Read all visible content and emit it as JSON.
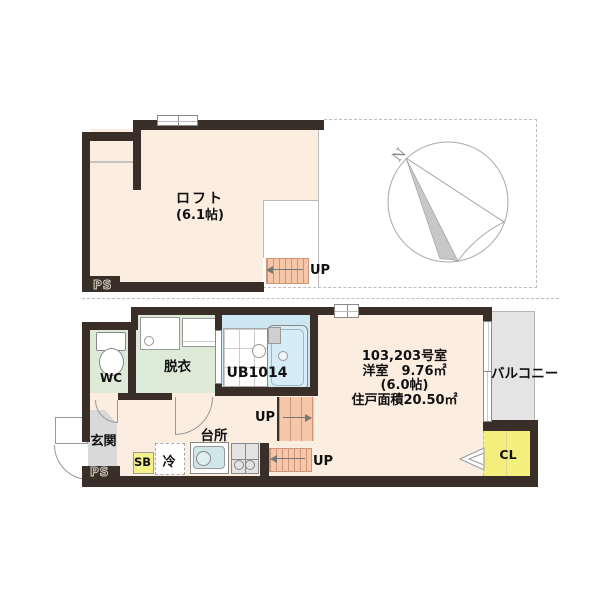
{
  "loft": {
    "name": "ロフト",
    "size": "(6.1帖)",
    "ps": "PS",
    "up": "UP"
  },
  "f1": {
    "wc": "WC",
    "dressing": "脱衣",
    "bath": "UB1014",
    "entrance": "玄関",
    "kitchen": "台所",
    "shoe_box": "SB",
    "fridge": "冷",
    "closet": "CL",
    "balcony": "バルコニー",
    "ps": "PS",
    "up_upper": "UP",
    "up_lower": "UP",
    "info_line1": "103,203号室",
    "info_line2": "洋室　9.76㎡",
    "info_line3": "(6.0帖)",
    "info_line4": "住戸面積20.50㎡"
  },
  "compass": {
    "north": "N"
  },
  "colors": {
    "wall": "#3a2f28",
    "floor_cream": "#fbeee1",
    "floor_green": "#dcead7",
    "floor_blue": "#cde7f2",
    "floor_yellow": "#f4ef7d",
    "balcony_gray": "#e4e4e4",
    "entrance_tile": "#d9d9d9",
    "stairs": "#f5c6a7",
    "stair_line": "#cf9478"
  }
}
